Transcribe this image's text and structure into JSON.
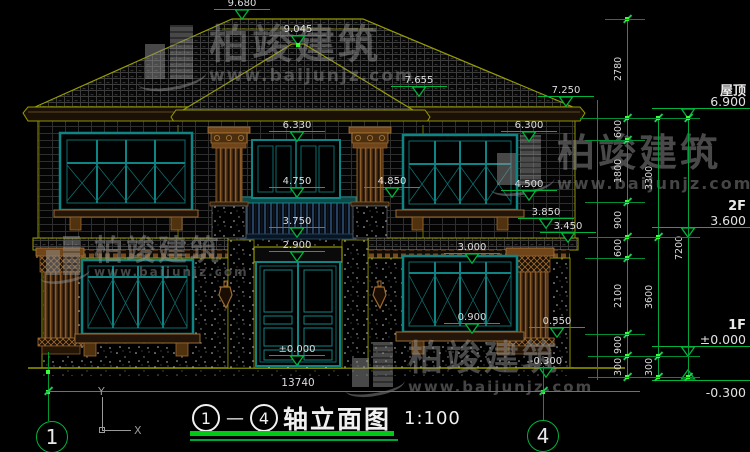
{
  "watermark": {
    "brand": "柏竣建筑",
    "url": "www.baijunjz.com"
  },
  "title_bar": {
    "axis_start": "1",
    "axis_end": "4",
    "separator": "—",
    "name": "轴立面图",
    "scale": "1:100"
  },
  "overall_width": {
    "label": "13740"
  },
  "ucs": {
    "x": "X",
    "y": "Y"
  },
  "levels_panel": [
    {
      "name": "屋顶",
      "value": "6.900",
      "y": 118
    },
    {
      "name": "2F",
      "value": "3.600",
      "y": 237
    },
    {
      "name": "1F",
      "value": "±0.000",
      "y": 356
    },
    {
      "name": "",
      "value": "-0.300",
      "y": 380,
      "flip": true
    }
  ],
  "elevation_marks": [
    {
      "label": "9.680",
      "x": 242,
      "y": 19
    },
    {
      "label": "9.045",
      "x": 298,
      "y": 45
    },
    {
      "label": "7.655",
      "x": 419,
      "y": 96
    },
    {
      "label": "7.250",
      "x": 566,
      "y": 106
    },
    {
      "label": "6.330",
      "x": 297,
      "y": 141
    },
    {
      "label": "6.300",
      "x": 529,
      "y": 141
    },
    {
      "label": "4.850",
      "x": 392,
      "y": 197
    },
    {
      "label": "4.750",
      "x": 297,
      "y": 197
    },
    {
      "label": "4.500",
      "x": 529,
      "y": 200
    },
    {
      "label": "3.850",
      "x": 546,
      "y": 228
    },
    {
      "label": "3.450",
      "x": 568,
      "y": 242
    },
    {
      "label": "3.750",
      "x": 297,
      "y": 237
    },
    {
      "label": "2.900",
      "x": 297,
      "y": 261
    },
    {
      "label": "3.000",
      "x": 472,
      "y": 263
    },
    {
      "label": "0.900",
      "x": 472,
      "y": 333
    },
    {
      "label": "0.550",
      "x": 557,
      "y": 337
    },
    {
      "label": "±0.000",
      "x": 297,
      "y": 365
    },
    {
      "label": "-0.300",
      "x": 546,
      "y": 377
    }
  ],
  "dim_chains": [
    {
      "x": 627,
      "segments": [
        {
          "label": "2780",
          "from": 19,
          "to": 118
        },
        {
          "label": "600",
          "from": 118,
          "to": 140
        },
        {
          "label": "1800",
          "from": 140,
          "to": 202
        },
        {
          "label": "900",
          "from": 202,
          "to": 237
        },
        {
          "label": "600",
          "from": 237,
          "to": 258
        },
        {
          "label": "2100",
          "from": 258,
          "to": 334
        },
        {
          "label": "900",
          "from": 334,
          "to": 356
        },
        {
          "label": "300",
          "from": 356,
          "to": 377
        }
      ]
    },
    {
      "x": 658,
      "segments": [
        {
          "label": "3300",
          "from": 118,
          "to": 237
        },
        {
          "label": "3600",
          "from": 237,
          "to": 356
        },
        {
          "label": "300",
          "from": 356,
          "to": 377
        }
      ]
    },
    {
      "x": 688,
      "segments": [
        {
          "label": "7200",
          "from": 118,
          "to": 377
        }
      ]
    }
  ],
  "ext_lines": [
    {
      "y": 19,
      "x1": 605,
      "x2": 645
    },
    {
      "y": 118,
      "x1": 580,
      "x2": 700
    },
    {
      "y": 140,
      "x1": 585,
      "x2": 645
    },
    {
      "y": 202,
      "x1": 585,
      "x2": 645
    },
    {
      "y": 237,
      "x1": 588,
      "x2": 700
    },
    {
      "y": 258,
      "x1": 585,
      "x2": 645
    },
    {
      "y": 334,
      "x1": 585,
      "x2": 645
    },
    {
      "y": 356,
      "x1": 588,
      "x2": 700
    },
    {
      "y": 377,
      "x1": 588,
      "x2": 700
    }
  ],
  "stems": [
    {
      "x": 597,
      "y1": 100,
      "y2": 380
    },
    {
      "x": 48,
      "y1": 352,
      "y2": 421
    },
    {
      "x": 543,
      "y1": 366,
      "y2": 421
    }
  ],
  "grips": [
    [
      48,
      372
    ],
    [
      543,
      392
    ],
    [
      298,
      45
    ],
    [
      48,
      392
    ]
  ],
  "axis_bubbles": [
    {
      "label": "1",
      "x": 52,
      "y": 437
    },
    {
      "label": "4",
      "x": 543,
      "y": 436
    }
  ],
  "overall_dim": {
    "y": 391,
    "x1": 46,
    "x2": 640,
    "ticks": [
      48,
      543
    ]
  }
}
